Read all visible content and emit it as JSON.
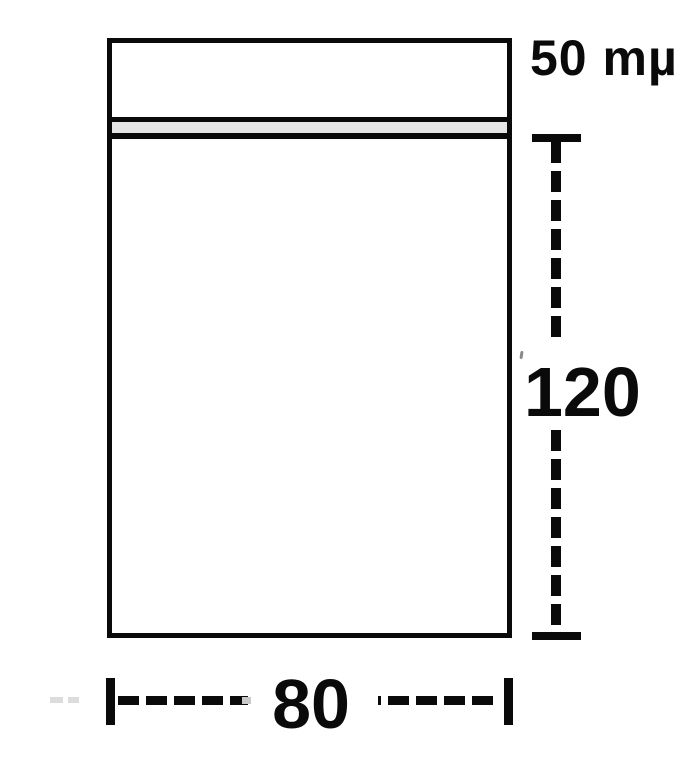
{
  "diagram": {
    "kind": "grip-seal-bag-dimension-drawing",
    "labels": {
      "thickness": "50 mµ",
      "height": "120",
      "width": "80"
    },
    "colors": {
      "line": "#0a0a0a",
      "zipper_band": "#e6e6e6",
      "background": "#ffffff",
      "faint_dash": "#dcdcdc"
    }
  }
}
